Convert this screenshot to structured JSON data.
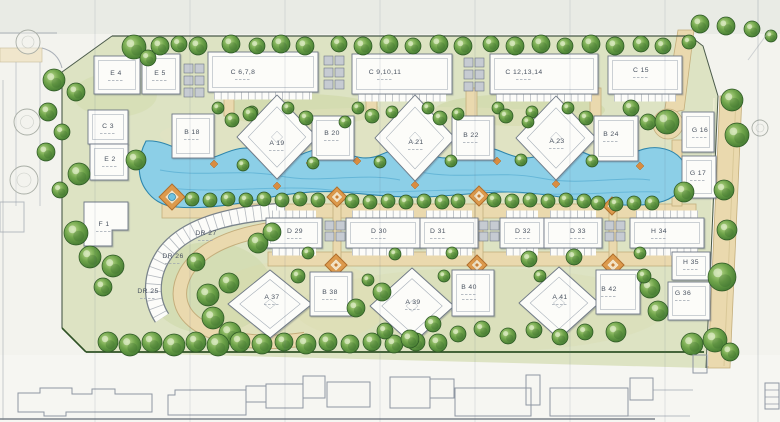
{
  "plan": {
    "title": "residential-site-plan",
    "buildings": [
      {
        "id": "E4",
        "label": "E 4"
      },
      {
        "id": "E5",
        "label": "E 5"
      },
      {
        "id": "C678",
        "label": "C 6,7,8"
      },
      {
        "id": "C91011",
        "label": "C 9,10,11"
      },
      {
        "id": "C121314",
        "label": "C 12,13,14"
      },
      {
        "id": "C15",
        "label": "C 15"
      },
      {
        "id": "G16",
        "label": "G 16"
      },
      {
        "id": "G17",
        "label": "G 17"
      },
      {
        "id": "C3",
        "label": "C 3"
      },
      {
        "id": "E2",
        "label": "E 2"
      },
      {
        "id": "F1",
        "label": "F 1"
      },
      {
        "id": "B18",
        "label": "B 18"
      },
      {
        "id": "A19",
        "label": "A 19"
      },
      {
        "id": "B20",
        "label": "B 20"
      },
      {
        "id": "A21",
        "label": "A 21"
      },
      {
        "id": "B22",
        "label": "B 22"
      },
      {
        "id": "A23",
        "label": "A 23"
      },
      {
        "id": "B24",
        "label": "B 24"
      },
      {
        "id": "DR27",
        "label": "DR 27"
      },
      {
        "id": "DR26",
        "label": "DR 26"
      },
      {
        "id": "DR25",
        "label": "DR 25"
      },
      {
        "id": "D29",
        "label": "D 29"
      },
      {
        "id": "D30",
        "label": "D 30"
      },
      {
        "id": "D31",
        "label": "D 31"
      },
      {
        "id": "D32",
        "label": "D 32"
      },
      {
        "id": "D33",
        "label": "D 33"
      },
      {
        "id": "H34",
        "label": "H 34"
      },
      {
        "id": "H35",
        "label": "H 35"
      },
      {
        "id": "A37",
        "label": "A 37"
      },
      {
        "id": "B38",
        "label": "B 38"
      },
      {
        "id": "A39",
        "label": "A 39"
      },
      {
        "id": "B40",
        "label": "B 40"
      },
      {
        "id": "A41",
        "label": "A 41"
      },
      {
        "id": "B42",
        "label": "B 42"
      },
      {
        "id": "G36",
        "label": "G 36"
      }
    ],
    "icons": {
      "tree": "tree-icon",
      "outline_tree": "outline-tree-icon",
      "plaza": "plaza-diamond-icon",
      "fountain": "fountain-icon"
    },
    "palette": {
      "paper": "#f3f3ee",
      "top_band": "#e9ebe5",
      "site_green": "#dde3c3",
      "lawn_dark": "#c9d49e",
      "road_tan": "#ead9ae",
      "water_blue": "#8ccfe7",
      "water_edge": "#2e86ad",
      "tree_green": "#4c8a38",
      "building_white": "#fcfcf9",
      "building_line": "#6e7885",
      "plaza_orange": "#dd9a4c",
      "boundary_green": "#2f5226",
      "label_gray": "#4a5360"
    }
  }
}
